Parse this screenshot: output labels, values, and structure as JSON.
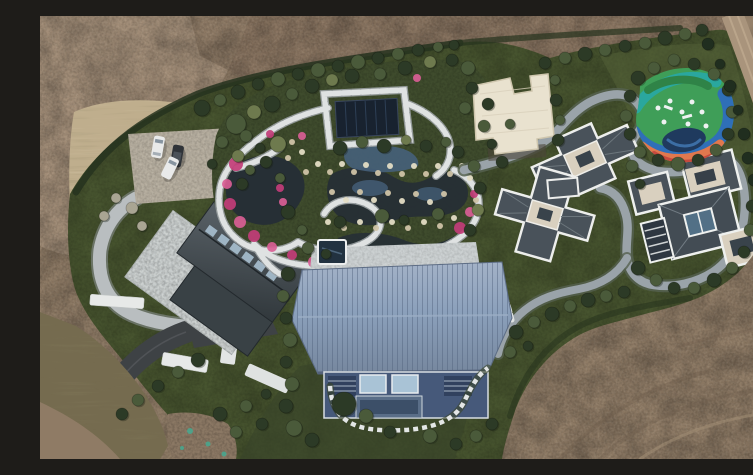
{
  "meta": {
    "kind": "aerial-drone-photograph",
    "width_px": 753,
    "height_px": 443
  },
  "scene": {
    "description": "Overhead aerial drone photograph of a landscaped private estate surrounded by bare brown earth: a large barn-style building with a blue metal roof, two gray-roofed villas, a cream flat-roofed pool house, a winding water garden with dark ponds, rocks and pink azalea beds, a colorful children's playground, a gravel parking pad with three cars, curving access roads and many specimen trees.",
    "landmarks": [
      "bare-dirt-field",
      "dry-grass-slope",
      "parking-pad-with-cars",
      "curved-light-road",
      "asphalt-driveway",
      "left-house-with-stone-patio",
      "water-garden",
      "pavilion-roof",
      "cream-pool-house",
      "blue-roof-barn",
      "east-villa",
      "right-villa",
      "playground",
      "gray-garden-path",
      "perimeter-hedge",
      "north-east-dirt-road"
    ],
    "counts": {
      "cars": 3,
      "buildings": 5,
      "ponds": 3
    },
    "tree_palette": {
      "d": "treeDark",
      "m": "treeMid",
      "o": "treeOlive",
      "l": "treeLight",
      "b": "treeBare",
      "p": "treePine"
    },
    "trees": [
      [
        162,
        92,
        8,
        "d"
      ],
      [
        180,
        84,
        6,
        "m"
      ],
      [
        198,
        76,
        7,
        "d"
      ],
      [
        218,
        68,
        6,
        "d"
      ],
      [
        238,
        63,
        7,
        "m"
      ],
      [
        258,
        58,
        6,
        "d"
      ],
      [
        278,
        54,
        7,
        "m"
      ],
      [
        298,
        50,
        6,
        "d"
      ],
      [
        318,
        46,
        7,
        "m"
      ],
      [
        338,
        42,
        6,
        "d"
      ],
      [
        358,
        38,
        6,
        "m"
      ],
      [
        378,
        34,
        6,
        "d"
      ],
      [
        398,
        31,
        5,
        "m"
      ],
      [
        414,
        29,
        5,
        "d"
      ],
      [
        505,
        47,
        6,
        "d"
      ],
      [
        525,
        42,
        6,
        "m"
      ],
      [
        545,
        38,
        7,
        "d"
      ],
      [
        565,
        34,
        6,
        "m"
      ],
      [
        585,
        30,
        6,
        "d"
      ],
      [
        605,
        27,
        6,
        "m"
      ],
      [
        625,
        22,
        7,
        "d"
      ],
      [
        645,
        18,
        6,
        "m"
      ],
      [
        662,
        14,
        6,
        "d"
      ],
      [
        196,
        108,
        10,
        "m"
      ],
      [
        214,
        96,
        7,
        "o"
      ],
      [
        232,
        88,
        8,
        "d"
      ],
      [
        252,
        78,
        6,
        "m"
      ],
      [
        272,
        70,
        7,
        "d"
      ],
      [
        292,
        64,
        6,
        "o"
      ],
      [
        312,
        60,
        7,
        "d"
      ],
      [
        340,
        58,
        6,
        "m"
      ],
      [
        365,
        52,
        7,
        "d"
      ],
      [
        390,
        46,
        6,
        "o"
      ],
      [
        412,
        44,
        6,
        "d"
      ],
      [
        428,
        52,
        7,
        "m"
      ],
      [
        432,
        72,
        6,
        "d"
      ],
      [
        425,
        92,
        6,
        "m"
      ],
      [
        238,
        128,
        8,
        "o"
      ],
      [
        226,
        146,
        6,
        "d"
      ],
      [
        240,
        162,
        5,
        "m"
      ],
      [
        182,
        126,
        6,
        "m"
      ],
      [
        172,
        148,
        5,
        "d"
      ],
      [
        300,
        132,
        7,
        "d"
      ],
      [
        322,
        126,
        6,
        "m"
      ],
      [
        344,
        130,
        7,
        "d"
      ],
      [
        366,
        124,
        5,
        "o"
      ],
      [
        386,
        130,
        6,
        "d"
      ],
      [
        406,
        126,
        5,
        "m"
      ],
      [
        248,
        196,
        7,
        "d"
      ],
      [
        262,
        214,
        5,
        "m"
      ],
      [
        300,
        206,
        6,
        "d"
      ],
      [
        342,
        200,
        7,
        "m"
      ],
      [
        364,
        204,
        5,
        "d"
      ],
      [
        398,
        198,
        6,
        "m"
      ],
      [
        418,
        136,
        6,
        "d"
      ],
      [
        434,
        150,
        6,
        "m"
      ],
      [
        440,
        172,
        6,
        "d"
      ],
      [
        438,
        194,
        6,
        "o"
      ],
      [
        430,
        214,
        6,
        "d"
      ],
      [
        448,
        88,
        6,
        "d"
      ],
      [
        444,
        110,
        6,
        "m"
      ],
      [
        452,
        128,
        5,
        "d"
      ],
      [
        515,
        64,
        5,
        "m"
      ],
      [
        516,
        84,
        6,
        "d"
      ],
      [
        520,
        104,
        5,
        "m"
      ],
      [
        518,
        124,
        6,
        "d"
      ],
      [
        598,
        62,
        7,
        "d"
      ],
      [
        614,
        52,
        6,
        "m"
      ],
      [
        590,
        80,
        6,
        "d"
      ],
      [
        586,
        100,
        6,
        "m"
      ],
      [
        590,
        118,
        6,
        "d"
      ],
      [
        600,
        136,
        6,
        "m"
      ],
      [
        618,
        144,
        6,
        "d"
      ],
      [
        638,
        148,
        7,
        "m"
      ],
      [
        658,
        144,
        6,
        "d"
      ],
      [
        676,
        134,
        6,
        "m"
      ],
      [
        688,
        118,
        6,
        "d"
      ],
      [
        692,
        96,
        6,
        "m"
      ],
      [
        688,
        74,
        6,
        "d"
      ],
      [
        674,
        58,
        6,
        "m"
      ],
      [
        654,
        48,
        6,
        "d"
      ],
      [
        634,
        44,
        6,
        "m"
      ],
      [
        668,
        28,
        6,
        "p"
      ],
      [
        680,
        48,
        5,
        "p"
      ],
      [
        690,
        70,
        6,
        "p"
      ],
      [
        698,
        94,
        5,
        "p"
      ],
      [
        704,
        118,
        6,
        "p"
      ],
      [
        708,
        142,
        6,
        "p"
      ],
      [
        714,
        164,
        6,
        "p"
      ],
      [
        592,
        150,
        6,
        "m"
      ],
      [
        600,
        168,
        5,
        "d"
      ],
      [
        470,
        108,
        5,
        "m"
      ],
      [
        462,
        146,
        6,
        "d"
      ],
      [
        598,
        252,
        7,
        "d"
      ],
      [
        616,
        264,
        6,
        "m"
      ],
      [
        634,
        272,
        6,
        "d"
      ],
      [
        654,
        272,
        6,
        "m"
      ],
      [
        674,
        264,
        7,
        "d"
      ],
      [
        692,
        252,
        6,
        "m"
      ],
      [
        704,
        236,
        6,
        "d"
      ],
      [
        710,
        214,
        6,
        "m"
      ],
      [
        712,
        190,
        6,
        "d"
      ],
      [
        476,
        316,
        7,
        "d"
      ],
      [
        494,
        306,
        6,
        "m"
      ],
      [
        512,
        298,
        7,
        "d"
      ],
      [
        530,
        290,
        6,
        "m"
      ],
      [
        548,
        284,
        7,
        "d"
      ],
      [
        566,
        280,
        6,
        "m"
      ],
      [
        584,
        276,
        6,
        "d"
      ],
      [
        470,
        336,
        6,
        "m"
      ],
      [
        488,
        330,
        5,
        "d"
      ],
      [
        248,
        258,
        7,
        "d"
      ],
      [
        243,
        280,
        6,
        "m"
      ],
      [
        246,
        302,
        6,
        "d"
      ],
      [
        250,
        324,
        7,
        "m"
      ],
      [
        246,
        346,
        6,
        "d"
      ],
      [
        252,
        368,
        7,
        "m"
      ],
      [
        246,
        390,
        7,
        "d"
      ],
      [
        254,
        412,
        8,
        "m"
      ],
      [
        272,
        424,
        7,
        "d"
      ],
      [
        304,
        388,
        12,
        "d"
      ],
      [
        326,
        400,
        7,
        "m"
      ],
      [
        350,
        416,
        6,
        "d"
      ],
      [
        390,
        420,
        7,
        "m"
      ],
      [
        416,
        428,
        6,
        "d"
      ],
      [
        436,
        420,
        6,
        "m"
      ],
      [
        452,
        408,
        6,
        "d"
      ],
      [
        92,
        192,
        6,
        "b"
      ],
      [
        76,
        182,
        5,
        "b"
      ],
      [
        64,
        200,
        5,
        "b"
      ],
      [
        102,
        210,
        5,
        "b"
      ],
      [
        206,
        120,
        6,
        "m"
      ],
      [
        220,
        132,
        5,
        "d"
      ],
      [
        158,
        344,
        7,
        "d"
      ],
      [
        138,
        356,
        6,
        "m"
      ],
      [
        118,
        370,
        6,
        "d"
      ],
      [
        98,
        384,
        6,
        "m"
      ],
      [
        82,
        398,
        6,
        "d"
      ],
      [
        180,
        398,
        7,
        "d"
      ],
      [
        206,
        390,
        6,
        "m"
      ],
      [
        226,
        378,
        5,
        "d"
      ],
      [
        196,
        416,
        6,
        "m"
      ],
      [
        222,
        408,
        6,
        "d"
      ],
      [
        198,
        140,
        6,
        "o"
      ],
      [
        210,
        154,
        5,
        "m"
      ],
      [
        202,
        168,
        6,
        "d"
      ],
      [
        268,
        232,
        6,
        "m"
      ],
      [
        286,
        238,
        5,
        "d"
      ]
    ],
    "flowers": [
      [
        196,
        148,
        7
      ],
      [
        187,
        168,
        5
      ],
      [
        190,
        188,
        6
      ],
      [
        200,
        206,
        6
      ],
      [
        214,
        220,
        6
      ],
      [
        232,
        231,
        5
      ],
      [
        252,
        239,
        5
      ],
      [
        274,
        246,
        6
      ],
      [
        298,
        251,
        5
      ],
      [
        324,
        252,
        5
      ],
      [
        350,
        250,
        5
      ],
      [
        372,
        246,
        4
      ],
      [
        240,
        172,
        4
      ],
      [
        243,
        186,
        4
      ],
      [
        420,
        212,
        6
      ],
      [
        430,
        196,
        5
      ],
      [
        434,
        178,
        4
      ],
      [
        377,
        62,
        4
      ],
      [
        300,
        234,
        4
      ],
      [
        262,
        120,
        4
      ],
      [
        230,
        118,
        4
      ]
    ],
    "rocks": [
      [
        266,
        156,
        3
      ],
      [
        278,
        148,
        3
      ],
      [
        290,
        156,
        3
      ],
      [
        302,
        148,
        3
      ],
      [
        314,
        156,
        3
      ],
      [
        326,
        149,
        3
      ],
      [
        338,
        157,
        3
      ],
      [
        350,
        150,
        3
      ],
      [
        362,
        158,
        3
      ],
      [
        374,
        150,
        3
      ],
      [
        386,
        158,
        3
      ],
      [
        398,
        150,
        3
      ],
      [
        410,
        158,
        3
      ],
      [
        422,
        150,
        3
      ],
      [
        292,
        176,
        3
      ],
      [
        306,
        184,
        3
      ],
      [
        320,
        176,
        3
      ],
      [
        334,
        184,
        3
      ],
      [
        348,
        177,
        3
      ],
      [
        362,
        185,
        3
      ],
      [
        376,
        178,
        3
      ],
      [
        390,
        186,
        3
      ],
      [
        404,
        178,
        3
      ],
      [
        288,
        206,
        3
      ],
      [
        304,
        212,
        3
      ],
      [
        320,
        206,
        3
      ],
      [
        336,
        212,
        3
      ],
      [
        352,
        206,
        3
      ],
      [
        368,
        212,
        3
      ],
      [
        384,
        206,
        3
      ],
      [
        400,
        210,
        3
      ],
      [
        414,
        202,
        3
      ],
      [
        252,
        126,
        3
      ],
      [
        262,
        136,
        3
      ],
      [
        248,
        142,
        3
      ],
      [
        430,
        162,
        3
      ],
      [
        436,
        184,
        3
      ],
      [
        300,
        240,
        3
      ],
      [
        316,
        244,
        3
      ],
      [
        332,
        242,
        3
      ],
      [
        348,
        244,
        3
      ],
      [
        364,
        240,
        3
      ]
    ],
    "teal_marks": [
      [
        150,
        415,
        3
      ],
      [
        168,
        428,
        2.5
      ],
      [
        184,
        438,
        2.5
      ],
      [
        142,
        432,
        2
      ]
    ]
  },
  "colors": {
    "dirtBase": "#8f7b65",
    "dirtDark": "#79664f",
    "dirtLight": "#a6907a",
    "dirtField": "#85715c",
    "dirtTR": "#97836c",
    "lawn": "#47542f",
    "lawnDark": "#38452a",
    "lawnBright": "#566439",
    "dryGrass": "#bfae8d",
    "brush": "#756b4f",
    "hedge": "#26331e",
    "treeDark": "#2c3a26",
    "treeMid": "#4a5a3a",
    "treeOlive": "#6e7a4e",
    "treeLight": "#93a06e",
    "treeBare": "#a9a593",
    "treePine": "#202e1f",
    "pathStone": "#dfe2e2",
    "pathStoneEdge": "#9aa0a2",
    "grayPath": "#9aa3a9",
    "grayPathEdge": "#55604f",
    "roadLight": "#b9bec0",
    "asphalt": "#3e4245",
    "water": "#262f35",
    "waterBlue": "#46607a",
    "poolDark": "#223240",
    "flowerPink": "#c23d78",
    "flowerPinkLight": "#d95e95",
    "rockLight": "#e3dcc4",
    "rockTan": "#cfc3a6",
    "barnRoof": "#8ba0bb",
    "barnWall": "#46597a",
    "barnWindow": "#a9c3d6",
    "slateRoof": "#49525a",
    "slateRoofLight": "#747e85",
    "trimWhite": "#edeeec",
    "creamFlat": "#d9d0bf",
    "whiteBldg": "#e9e2cf",
    "pavilion": "#18222f",
    "playGreen": "#3f9e58",
    "playGreenDark": "#2f8347",
    "playTeal": "#2aa79e",
    "playBlue": "#2f6fb8",
    "playOrange": "#e0784e",
    "playRed": "#c64a3e",
    "playNavy": "#1f3a5e",
    "playWhite": "#eef2f2",
    "carWhite": "#e9eaea",
    "carDark": "#2f3338",
    "patio": "#c6cbcb",
    "roofLeft": "#454d52",
    "skylight": "#a9c0d0",
    "tealMark": "#45a990",
    "parkingPad": "#b3ab9c"
  }
}
